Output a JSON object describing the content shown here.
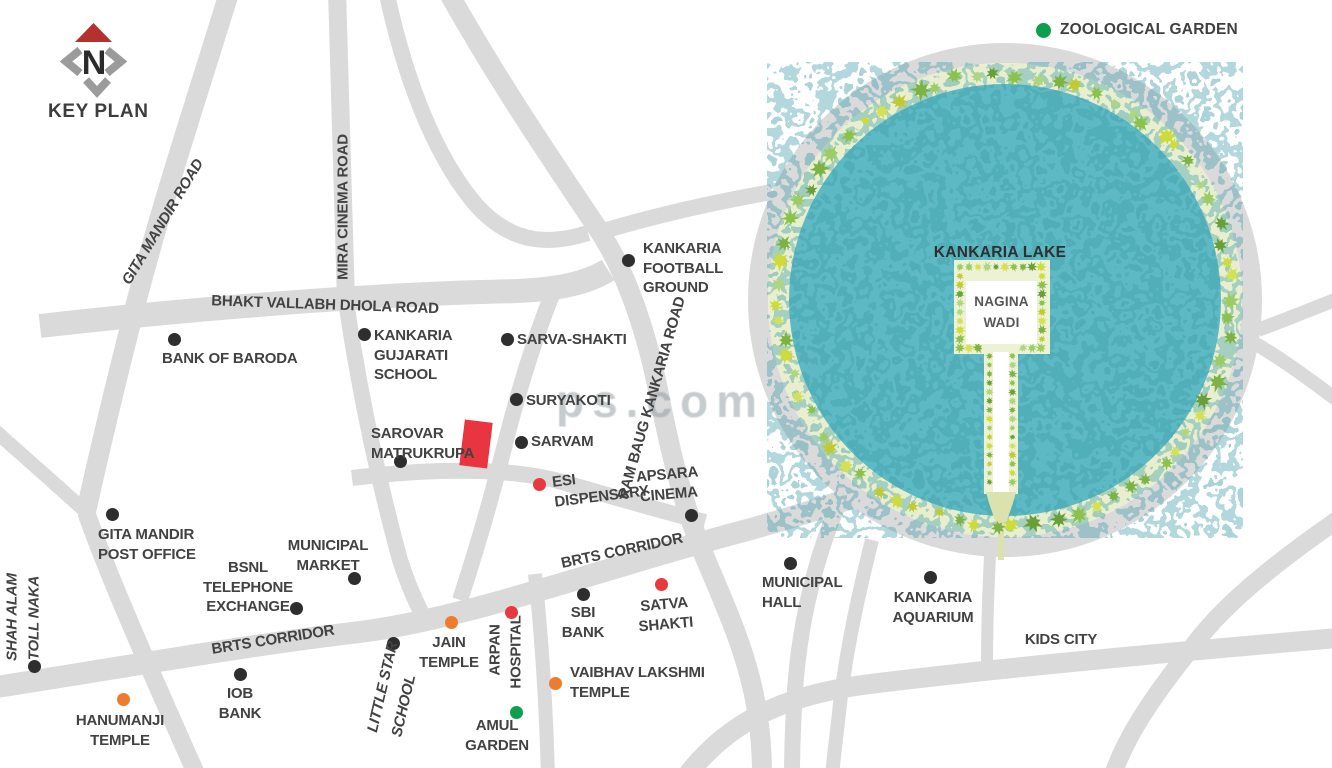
{
  "title": "KEY PLAN",
  "compass": {
    "north_letter": "N"
  },
  "legend": {
    "zoological_garden": "ZOOLOGICAL GARDEN"
  },
  "lake": {
    "name": "KANKARIA LAKE",
    "island": "NAGINA WADI"
  },
  "watermark": "ps.com",
  "colors": {
    "road": "#dadada",
    "water": "#5db9c3",
    "water_dark": "#3f9fab",
    "green_belt": "#e9efce",
    "site": "#e8353f",
    "label": "#424242",
    "black": "#2e2e2e",
    "red": "#e8393f",
    "orange": "#ee7b2e",
    "green": "#0c9f4d",
    "compass_red": "#b5312f",
    "compass_gray": "#9b9b9b",
    "tree_palette": [
      "#8bc34a",
      "#aed581",
      "#c0ca33",
      "#d4e157",
      "#7cb342",
      "#9ccc65",
      "#cddc39",
      "#689f38"
    ]
  },
  "map_labels": [
    {
      "id": "gita-mandir-road",
      "lines": [
        "GITA MANDIR ROAD"
      ],
      "x": 163,
      "y": 222,
      "anchor": "cc",
      "rotate": -59,
      "italic": true
    },
    {
      "id": "mira-cinema-road",
      "lines": [
        "MIRA CINEMA ROAD"
      ],
      "x": 343,
      "y": 207,
      "anchor": "cc",
      "rotate": -90
    },
    {
      "id": "bhakt-vallabh-dhola-road",
      "lines": [
        "BHAKT VALLABH DHOLA ROAD"
      ],
      "x": 325,
      "y": 305,
      "anchor": "cc",
      "rotate": 2
    },
    {
      "id": "ram-baug-kankaria-road",
      "lines": [
        "RAM BAUG KANKARIA ROAD"
      ],
      "x": 652,
      "y": 398,
      "anchor": "cc",
      "rotate": -74
    },
    {
      "id": "brts-corridor-upper",
      "lines": [
        "BRTS CORRIDOR"
      ],
      "x": 622,
      "y": 551,
      "anchor": "cc",
      "rotate": -12
    },
    {
      "id": "brts-corridor-lower",
      "lines": [
        "BRTS CORRIDOR"
      ],
      "x": 273,
      "y": 640,
      "anchor": "cc",
      "rotate": -9
    },
    {
      "id": "bank-of-baroda",
      "lines": [
        "BANK OF BARODA"
      ],
      "x": 162,
      "y": 349,
      "anchor": "tl",
      "dot": {
        "x": 174,
        "y": 339,
        "color": "black"
      }
    },
    {
      "id": "kankaria-gujarati-school",
      "lines": [
        "KANKARIA",
        "GUJARATI",
        "SCHOOL"
      ],
      "x": 374,
      "y": 326,
      "anchor": "tl",
      "dot": {
        "x": 364,
        "y": 334,
        "color": "black"
      }
    },
    {
      "id": "sarva-shakti",
      "lines": [
        "SARVA-SHAKTI"
      ],
      "x": 517,
      "y": 330,
      "anchor": "tl",
      "dot": {
        "x": 507,
        "y": 339,
        "color": "black"
      }
    },
    {
      "id": "suryakoti",
      "lines": [
        "SURYAKOTI"
      ],
      "x": 526,
      "y": 391,
      "anchor": "tl",
      "dot": {
        "x": 516,
        "y": 399,
        "color": "black"
      }
    },
    {
      "id": "kankaria-football-ground",
      "lines": [
        "KANKARIA",
        "FOOTBALL",
        "GROUND"
      ],
      "x": 643,
      "y": 239,
      "anchor": "tl",
      "dot": {
        "x": 628,
        "y": 260,
        "color": "black"
      }
    },
    {
      "id": "sarovar-matrukrupa",
      "lines": [
        "SAROVAR",
        "MATRUKRUPA"
      ],
      "x": 371,
      "y": 424,
      "anchor": "tl",
      "dot": {
        "x": 400,
        "y": 461,
        "color": "black"
      }
    },
    {
      "id": "sarvam",
      "lines": [
        "SARVAM"
      ],
      "x": 531,
      "y": 432,
      "anchor": "tl",
      "dot": {
        "x": 521,
        "y": 442,
        "color": "black"
      }
    },
    {
      "id": "esi-dispensary",
      "lines": [
        "ESI",
        "DISPENSARY"
      ],
      "x": 551,
      "y": 473,
      "anchor": "tl",
      "rotate": -7,
      "dot": {
        "x": 539,
        "y": 484,
        "color": "red"
      }
    },
    {
      "id": "apsara-cinema",
      "lines": [
        "APSARA",
        "CINEMA"
      ],
      "x": 668,
      "y": 465,
      "anchor": "tc",
      "rotate": -5,
      "dot": {
        "x": 691,
        "y": 515,
        "color": "black"
      }
    },
    {
      "id": "gita-mandir-post-office",
      "lines": [
        "GITA MANDIR",
        "POST OFFICE"
      ],
      "x": 98,
      "y": 525,
      "anchor": "tl",
      "dot": {
        "x": 112,
        "y": 514,
        "color": "black"
      }
    },
    {
      "id": "municipal-market",
      "lines": [
        "MUNICIPAL",
        "MARKET"
      ],
      "x": 328,
      "y": 536,
      "anchor": "tc",
      "dot": {
        "x": 354,
        "y": 578,
        "color": "black"
      }
    },
    {
      "id": "bsnl-telephone-exchange",
      "lines": [
        "BSNL",
        "TELEPHONE",
        "EXCHANGE"
      ],
      "x": 248,
      "y": 558,
      "anchor": "tc",
      "dot": {
        "x": 296,
        "y": 608,
        "color": "black"
      }
    },
    {
      "id": "shah-alam",
      "lines": [
        "SHAH ALAM"
      ],
      "x": 12,
      "y": 617,
      "anchor": "cc",
      "rotate": -90,
      "italic": true,
      "dot": {
        "x": 34,
        "y": 666,
        "color": "black"
      }
    },
    {
      "id": "toll-naka",
      "lines": [
        "TOLL NAKA"
      ],
      "x": 34,
      "y": 618,
      "anchor": "cc",
      "rotate": -90,
      "italic": true
    },
    {
      "id": "hanumanji-temple",
      "lines": [
        "HANUMANJI",
        "TEMPLE"
      ],
      "x": 120,
      "y": 711,
      "anchor": "tc",
      "dot": {
        "x": 123,
        "y": 699,
        "color": "orange"
      }
    },
    {
      "id": "iob-bank",
      "lines": [
        "IOB",
        "BANK"
      ],
      "x": 240,
      "y": 684,
      "anchor": "tc",
      "dot": {
        "x": 240,
        "y": 674,
        "color": "black"
      }
    },
    {
      "id": "little-star",
      "lines": [
        "LITTLE STAR"
      ],
      "x": 383,
      "y": 687,
      "anchor": "cc",
      "rotate": -77,
      "italic": true,
      "dot": {
        "x": 393,
        "y": 643,
        "color": "black"
      }
    },
    {
      "id": "little-star-school",
      "lines": [
        "SCHOOL"
      ],
      "x": 404,
      "y": 706,
      "anchor": "cc",
      "rotate": -77,
      "italic": true
    },
    {
      "id": "jain-temple",
      "lines": [
        "JAIN",
        "TEMPLE"
      ],
      "x": 449,
      "y": 633,
      "anchor": "tc",
      "dot": {
        "x": 451,
        "y": 622,
        "color": "orange"
      }
    },
    {
      "id": "arpan",
      "lines": [
        "ARPAN"
      ],
      "x": 495,
      "y": 650,
      "anchor": "cc",
      "rotate": -90,
      "dot": {
        "x": 511,
        "y": 612,
        "color": "red"
      }
    },
    {
      "id": "arpan-hospital",
      "lines": [
        "HOSPITAL"
      ],
      "x": 516,
      "y": 652,
      "anchor": "cc",
      "rotate": -90
    },
    {
      "id": "amul-garden",
      "lines": [
        "AMUL",
        "GARDEN"
      ],
      "x": 497,
      "y": 716,
      "anchor": "tc",
      "dot": {
        "x": 516,
        "y": 712,
        "color": "green"
      }
    },
    {
      "id": "vaibhav-lakshmi-temple",
      "lines": [
        "VAIBHAV LAKSHMI",
        "TEMPLE"
      ],
      "x": 570,
      "y": 663,
      "anchor": "tl",
      "dot": {
        "x": 555,
        "y": 683,
        "color": "orange"
      }
    },
    {
      "id": "sbi-bank",
      "lines": [
        "SBI",
        "BANK"
      ],
      "x": 583,
      "y": 603,
      "anchor": "tc",
      "dot": {
        "x": 583,
        "y": 594,
        "color": "black"
      }
    },
    {
      "id": "satva-shakti",
      "lines": [
        "SATVA",
        "SHAKTI"
      ],
      "x": 665,
      "y": 595,
      "anchor": "tc",
      "rotate": -5,
      "dot": {
        "x": 661,
        "y": 584,
        "color": "red"
      }
    },
    {
      "id": "municipal-hall",
      "lines": [
        "MUNICIPAL",
        "HALL"
      ],
      "x": 762,
      "y": 573,
      "anchor": "tl",
      "dot": {
        "x": 790,
        "y": 563,
        "color": "black"
      }
    },
    {
      "id": "kankaria-aquarium",
      "lines": [
        "KANKARIA",
        "AQUARIUM"
      ],
      "x": 933,
      "y": 588,
      "anchor": "tc",
      "dot": {
        "x": 930,
        "y": 577,
        "color": "black"
      }
    },
    {
      "id": "kids-city",
      "lines": [
        "KIDS CITY"
      ],
      "x": 1061,
      "y": 630,
      "anchor": "tc"
    }
  ]
}
